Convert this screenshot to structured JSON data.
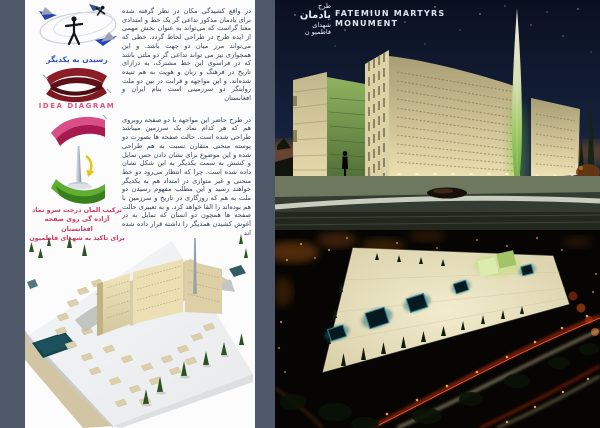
{
  "left_panel": {
    "sketch_caption": "رسیدن به یکدیگر",
    "diagram_title": "IDEA DIAGRAM",
    "concept_caption_lines": [
      "ترکیب المان درخت سرو نماد",
      "آزاده گی روی صفحه افغانستان",
      "برای تاکید به شهدای فاطمیون"
    ]
  },
  "description_column": {
    "paragraph_1": "در واقع کشیدگی مکان در نظر گرفته شده برای یادمان مذکور تداعی گر یک خط و امتدادی معنا گراست که می‌تواند به عنوان بخش مهمی از ایده طرح در طراحی لحاظ گردد. خطی که می‌تواند مرز میان دو جهت باشد. و این همجواری نیز می تواند تداعی گر دو ملتی باشد که در فراسوی این خط مشترک، به درازای تاریخ در فرهنگ و زبان و هویت به هم تنیده شده‌اند. و این مواجهه و قرابت در بین دو ملت روایتگر دو سرزمینی است بنام ایران و افغانستان",
    "paragraph_2": "در طرح حاضر این مواجهه با دو صفحه روبروی هم که هر کدام نماد یک سرزمین میباشد طراحی شده است. حالت صفحه ها بصورت دو پوسته منحنی متقارن نسبت به هم طراحی شده و این موضوع برای نشان دادن حس تمایل و کشش به سمت یکدیگر به این شکل نشان داده شده است. چرا که انتظار می‌رود دو خط منحنی و غیر متوازی در امتداد هم به یکدیگر خواهند رسید و این مطلب مفهوم رسیدن دو ملت به هم که روزگاری در تاریخ و سرزمین با هم بوده‌اند را القا خواهد کرد. و به تعبیری حالت صفحه ها همچون دو انسان که تمایل به در آغوش کشیدن همدیگر را داشته قرار داده شده اند"
  },
  "night_elevation_render": {
    "project_title_fa_lines": [
      "طرح",
      "یادمان",
      "شهدای",
      "فاطمیو ن"
    ],
    "project_title_en_lines": [
      "FATEMIUN MARTYRS",
      "MONUMENT"
    ]
  },
  "colors": {
    "page_background": "#4f5868",
    "panel_background": "#fcfcfd",
    "body_text_navy": "#2c3c58",
    "caption_pink": "#d63560",
    "label_blue": "#2a52c8",
    "diagram_title_pink": "#e4547a",
    "night_sky": "#0d1526",
    "wall_cream": "#d9cda2",
    "spire_green": "#7fc24a",
    "pool_teal": "#15444c",
    "courtyard_glow_teal": "#2f8292",
    "city_light_orange": "#e89a3c"
  }
}
